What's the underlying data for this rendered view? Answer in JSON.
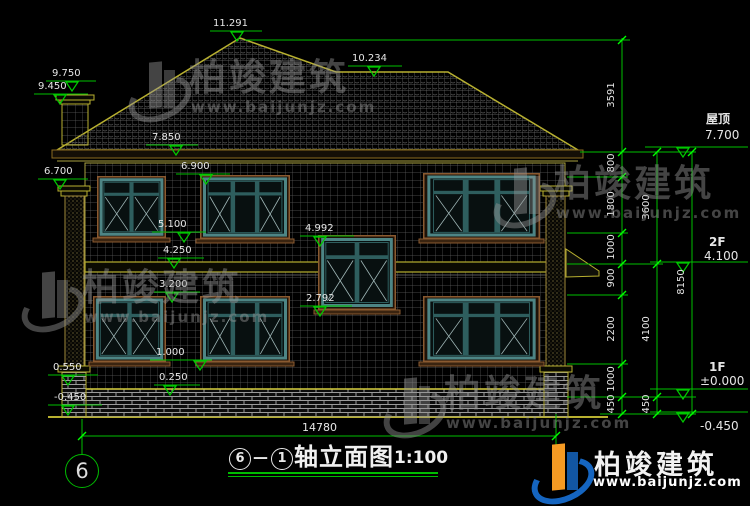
{
  "markers": {
    "peak": "11.291",
    "ridge": "10.234",
    "chimney_top": "9.750",
    "chimney_shoulder": "9.450",
    "eave": "7.850",
    "win2f_top": "6.900",
    "pilaster_top": "6.700",
    "win2f_sill": "5.100",
    "stair_win_top": "4.992",
    "floor_band": "4.250",
    "win1f_top": "3.200",
    "stair_win_sill": "2.792",
    "win1f_sill": "1.000",
    "pedestal_top": "0.550",
    "plinth_top": "0.250",
    "ground_left": "-0.450"
  },
  "floor_levels": {
    "roof_label": "屋顶",
    "roof_value": "7.700",
    "f2_label": "2F",
    "f2_value": "4.100",
    "f1_label": "1F",
    "f1_value": "±0.000",
    "basement_value": "-0.450"
  },
  "dimensions": {
    "col_inner": [
      "3591",
      "800",
      "1800",
      "1000",
      "900",
      "2200",
      "1000",
      "450"
    ],
    "col_mid": [
      "3600",
      "4100",
      "450"
    ],
    "col_outer": [
      "8150"
    ],
    "overall_width": "14780"
  },
  "axis": {
    "left_bubble": "6"
  },
  "title": {
    "axis_from": "6",
    "dash": "—",
    "axis_to": "1",
    "name": "轴立面图",
    "scale": "1:100"
  },
  "watermark": {
    "brand": "柏竣建筑",
    "url": "www.baijunjz.com"
  },
  "logo": {
    "brand": "柏竣建筑",
    "url": "www.baijunjz.com"
  }
}
